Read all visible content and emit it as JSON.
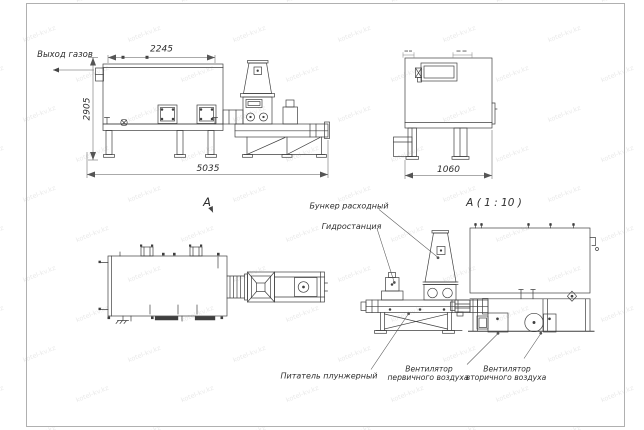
{
  "watermark": {
    "text": "kotel-kv.kz"
  },
  "labels": {
    "gas_outlet": "Выход газов",
    "feed_hopper": "Бункер расходный",
    "hydraulic_station": "Гидростанция",
    "plunger_feeder": "Питатель плунжерный",
    "primary_fan_line1": "Вентилятор",
    "primary_fan_line2": "первичного воздуха",
    "secondary_fan_line1": "Вентилятор",
    "secondary_fan_line2": "вторичного воздуха",
    "section_marker": "А",
    "detail_view_title": "А ( 1 : 10 )"
  },
  "dimensions": {
    "top_width": "2245",
    "overall_height": "2905",
    "total_length": "5035",
    "side_width": "1060"
  },
  "colors": {
    "line": "#3f3f3f",
    "dimension": "#555555",
    "frame": "#9a9a9a",
    "background": "#ffffff"
  }
}
